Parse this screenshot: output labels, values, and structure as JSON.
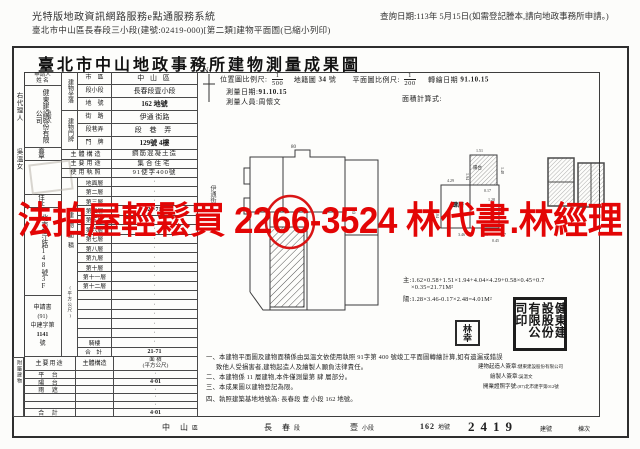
{
  "page_header": {
    "system_title": "光特版地政資訊網路服務e點通服務系統",
    "document_line": "臺北市中山區長春段三小段(建號:02419-000)[第二類]建物平面圖(已縮小列印)",
    "query_date": "查詢日期:113年 5月15日(如需登記謄本,請向地政事務所申請。)"
  },
  "doc": {
    "title": "臺北市中山地政事務所建物測量成果圖",
    "agent": {
      "label": "右代理人",
      "name": "吳溫女"
    },
    "applicant": {
      "header_l1": "申請人",
      "header_l2": "姓 名",
      "name": "健東建設股份有限公司",
      "side_note": "負責人",
      "seal_row": "蓋 章",
      "address_label": "住 址",
      "address": "北市松江路148號3F",
      "app_book_l1": "申請書",
      "app_book_l2": "(91)",
      "app_book_l3": "中建字第",
      "app_book_l4": "1141",
      "app_book_l5": "號"
    },
    "location_section": "建物坐落",
    "location_rows": [
      {
        "label": "市　區",
        "value": "中 山 區"
      },
      {
        "label": "段小段",
        "value": "長春段壹小段"
      },
      {
        "label": "地　號",
        "value": "162 地號"
      }
    ],
    "plate_section": "建物門牌",
    "plate_rows": [
      {
        "label": "街　路",
        "value": "伊通 街路"
      },
      {
        "label": "段巷弄",
        "value": "段 巷 弄"
      },
      {
        "label": "門　牌",
        "value": "129號 4樓"
      }
    ],
    "info_rows": [
      {
        "label": "主體構造",
        "value": "鋼筋混凝土造"
      },
      {
        "label": "主要用途",
        "value": "集合住宅"
      },
      {
        "label": "使用執照",
        "value": "91使字400號"
      }
    ],
    "floor_section": "建物面積",
    "floor_unit": "(平方公尺)",
    "floors": [
      {
        "label": "地面層",
        "value": "·"
      },
      {
        "label": "第二層",
        "value": "·"
      },
      {
        "label": "第三層",
        "value": "·"
      },
      {
        "label": "第四層",
        "value": "21·71"
      },
      {
        "label": "第五層",
        "value": "·"
      },
      {
        "label": "第六層",
        "value": "·"
      },
      {
        "label": "第七層",
        "value": "·"
      },
      {
        "label": "第八層",
        "value": "·"
      },
      {
        "label": "第九層",
        "value": "·"
      },
      {
        "label": "第十層",
        "value": "·"
      },
      {
        "label": "第十一層",
        "value": "·"
      },
      {
        "label": "第十二層",
        "value": "·"
      },
      {
        "label": "",
        "value": "·"
      },
      {
        "label": "",
        "value": "·"
      },
      {
        "label": "",
        "value": "·"
      },
      {
        "label": "",
        "value": "·"
      },
      {
        "label": "",
        "value": "·"
      },
      {
        "label": "騎樓",
        "value": "·"
      },
      {
        "label": "合 計",
        "value": "21-71"
      }
    ],
    "attached": {
      "section": "附屬建物",
      "h_use": "主要用途",
      "h_struct": "主體構造",
      "h_area1": "面 積",
      "h_area2": "(平方公尺)",
      "rows": [
        {
          "label": "平 台",
          "struct": "",
          "value": "·"
        },
        {
          "label": "陽 台",
          "struct": "",
          "value": "4·01"
        },
        {
          "label": "雨 遮",
          "struct": "",
          "value": "·"
        },
        {
          "label": "",
          "struct": "",
          "value": "·"
        },
        {
          "label": "",
          "struct": "",
          "value": "·"
        },
        {
          "label": "合 計",
          "struct": "",
          "value": "4·01"
        }
      ]
    },
    "survey": {
      "north": "N",
      "loc_scale_label": "位置圖比例尺:",
      "loc_scale_num": "1",
      "loc_scale_den": "500",
      "cadastre_label": "地籍圖",
      "cadastre_no": "34",
      "cadastre_suffix": "號",
      "plan_scale_label": "平面圖比例尺:",
      "plan_scale_num": "1",
      "plan_scale_den": "200",
      "redraw_label": "轉繪日期",
      "redraw_date": "91.10.15",
      "date_label": "測量日期:",
      "date": "91.10.15",
      "person_label": "測量人員:",
      "person": "周懷文",
      "calc_label": "面積計算式:"
    },
    "calc": {
      "main": "主:1.62×0.58+1.51×1.94+4.04×4.29+0.58×0.45+0.7",
      "main2": "×0.35=21.71M²",
      "balcony": "陽:1.28×3.46-0.17×2.48=4.01M²"
    },
    "plan": {
      "street": "伊通街",
      "lot_top": "80",
      "lot_right": "80",
      "floor_label": "肆層",
      "balcony_label": "陽台",
      "dims": {
        "top": "1.51",
        "left": "1.94",
        "right": "1.48",
        "w1": "4.29",
        "w2": "4.04",
        "cut": "0.17",
        "bw": "1.28",
        "bl": "3.46",
        "e1": "0.58",
        "e2": "0.45",
        "e3": "0.7"
      }
    },
    "stamps": {
      "builder_seal": "健東建設股份有限公司印",
      "name_seal": "林幸"
    },
    "notes": [
      "一、本建物平面圖及建物面積係由吳溫文依使用執照 91字第 400 號竣工平面圖轉繪計算,如有遺漏或錯誤",
      "致他人受損害者,建物起造人及繪製人願負法律責任。",
      "二、本建物係 11 層建物,本件僅測量第 肆 層部分。",
      "三、本成果圖以建物登記為限。",
      "四、執照建築基地地號為: 長春段 壹 小段 162 地號。"
    ],
    "signatures": {
      "builder_label": "建物起造人簽章:",
      "builder": "健東建設股份有限公司",
      "drafter_label": "繪製人簽章:",
      "drafter": "吳溫文",
      "license_label": "開業證照字號:",
      "license": "(87)北市建字第012號"
    },
    "footer": {
      "district": "中 山",
      "district_suffix": "區",
      "section": "長 春",
      "section_suffix": "段",
      "subsection": "壹",
      "subsection_suffix": "小段",
      "land_no": "162",
      "land_suffix": "地號",
      "building_no": "2419",
      "building_suffix": "建號",
      "dong": "棟次"
    }
  },
  "watermark": {
    "text": "法拍屋輕鬆買  2266-3524  林代書.林經理",
    "color": "#e30505"
  }
}
